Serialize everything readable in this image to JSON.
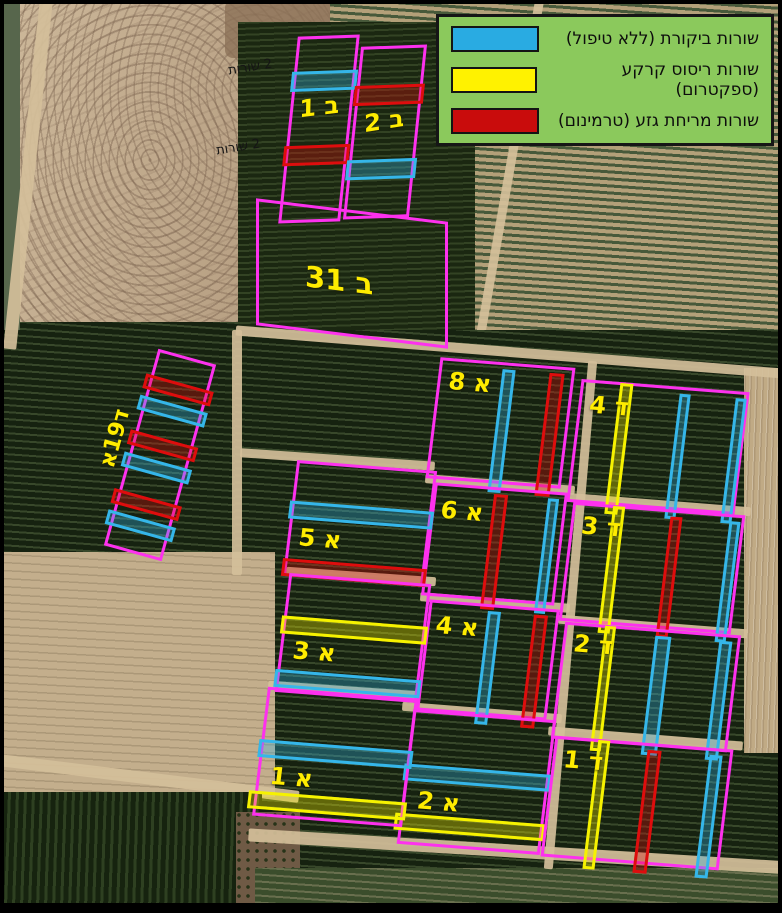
{
  "title": "Orchard treatment trial aerial map",
  "colors": {
    "plot_outline_magenta": "#fd31ee",
    "control_blue": "#29abe2",
    "ground_spray_yellow": "#fff200",
    "trunk_smear_red": "#c90c0c",
    "legend_background_green": "#8bc95c",
    "plot_label_yellow": "#ffec00"
  },
  "legend": {
    "items": [
      {
        "key": "control",
        "label": "שורות ביקורת (ללא טיפול)",
        "color": "#29abe2"
      },
      {
        "key": "ground_spray",
        "label": "שורות ריסוס קרקע (ספקטרום)",
        "color": "#fff200"
      },
      {
        "key": "trunk_smear",
        "label": "שורות מריחת גזע (טרמינום)",
        "color": "#c90c0c"
      }
    ]
  },
  "notes": [
    {
      "text": "2 שורות"
    },
    {
      "text": "2 שורות"
    }
  ],
  "plots": [
    {
      "id": "b1",
      "label": "ב 1",
      "bars": [
        "control",
        "trunk_smear"
      ]
    },
    {
      "id": "b2",
      "label": "ב 2",
      "bars": [
        "trunk_smear",
        "control"
      ]
    },
    {
      "id": "b31",
      "label": "ב 31",
      "bars": []
    },
    {
      "id": "d19a",
      "label": "ד19א",
      "bars": [
        "trunk_smear",
        "control",
        "trunk_smear",
        "control",
        "trunk_smear",
        "control"
      ]
    },
    {
      "id": "a8",
      "label": "א 8",
      "bars": [
        "control",
        "trunk_smear"
      ]
    },
    {
      "id": "a6",
      "label": "א 6",
      "bars": [
        "trunk_smear",
        "control"
      ]
    },
    {
      "id": "a4",
      "label": "א 4",
      "bars": [
        "control",
        "trunk_smear"
      ]
    },
    {
      "id": "a2",
      "label": "א 2",
      "bars": [
        "control",
        "ground_spray"
      ]
    },
    {
      "id": "a5",
      "label": "א 5",
      "bars": [
        "control",
        "trunk_smear"
      ]
    },
    {
      "id": "a3",
      "label": "א 3",
      "bars": [
        "ground_spray",
        "control"
      ]
    },
    {
      "id": "a1",
      "label": "א 1",
      "bars": [
        "control",
        "ground_spray"
      ]
    },
    {
      "id": "d4",
      "label": "ד 4",
      "bars": [
        "ground_spray",
        "control",
        "control"
      ]
    },
    {
      "id": "d3",
      "label": "ד 3",
      "bars": [
        "ground_spray",
        "trunk_smear",
        "control"
      ]
    },
    {
      "id": "d2",
      "label": "ד 2",
      "bars": [
        "ground_spray",
        "control",
        "control"
      ]
    },
    {
      "id": "d1",
      "label": "ד 1",
      "bars": [
        "ground_spray",
        "trunk_smear",
        "control"
      ]
    }
  ]
}
